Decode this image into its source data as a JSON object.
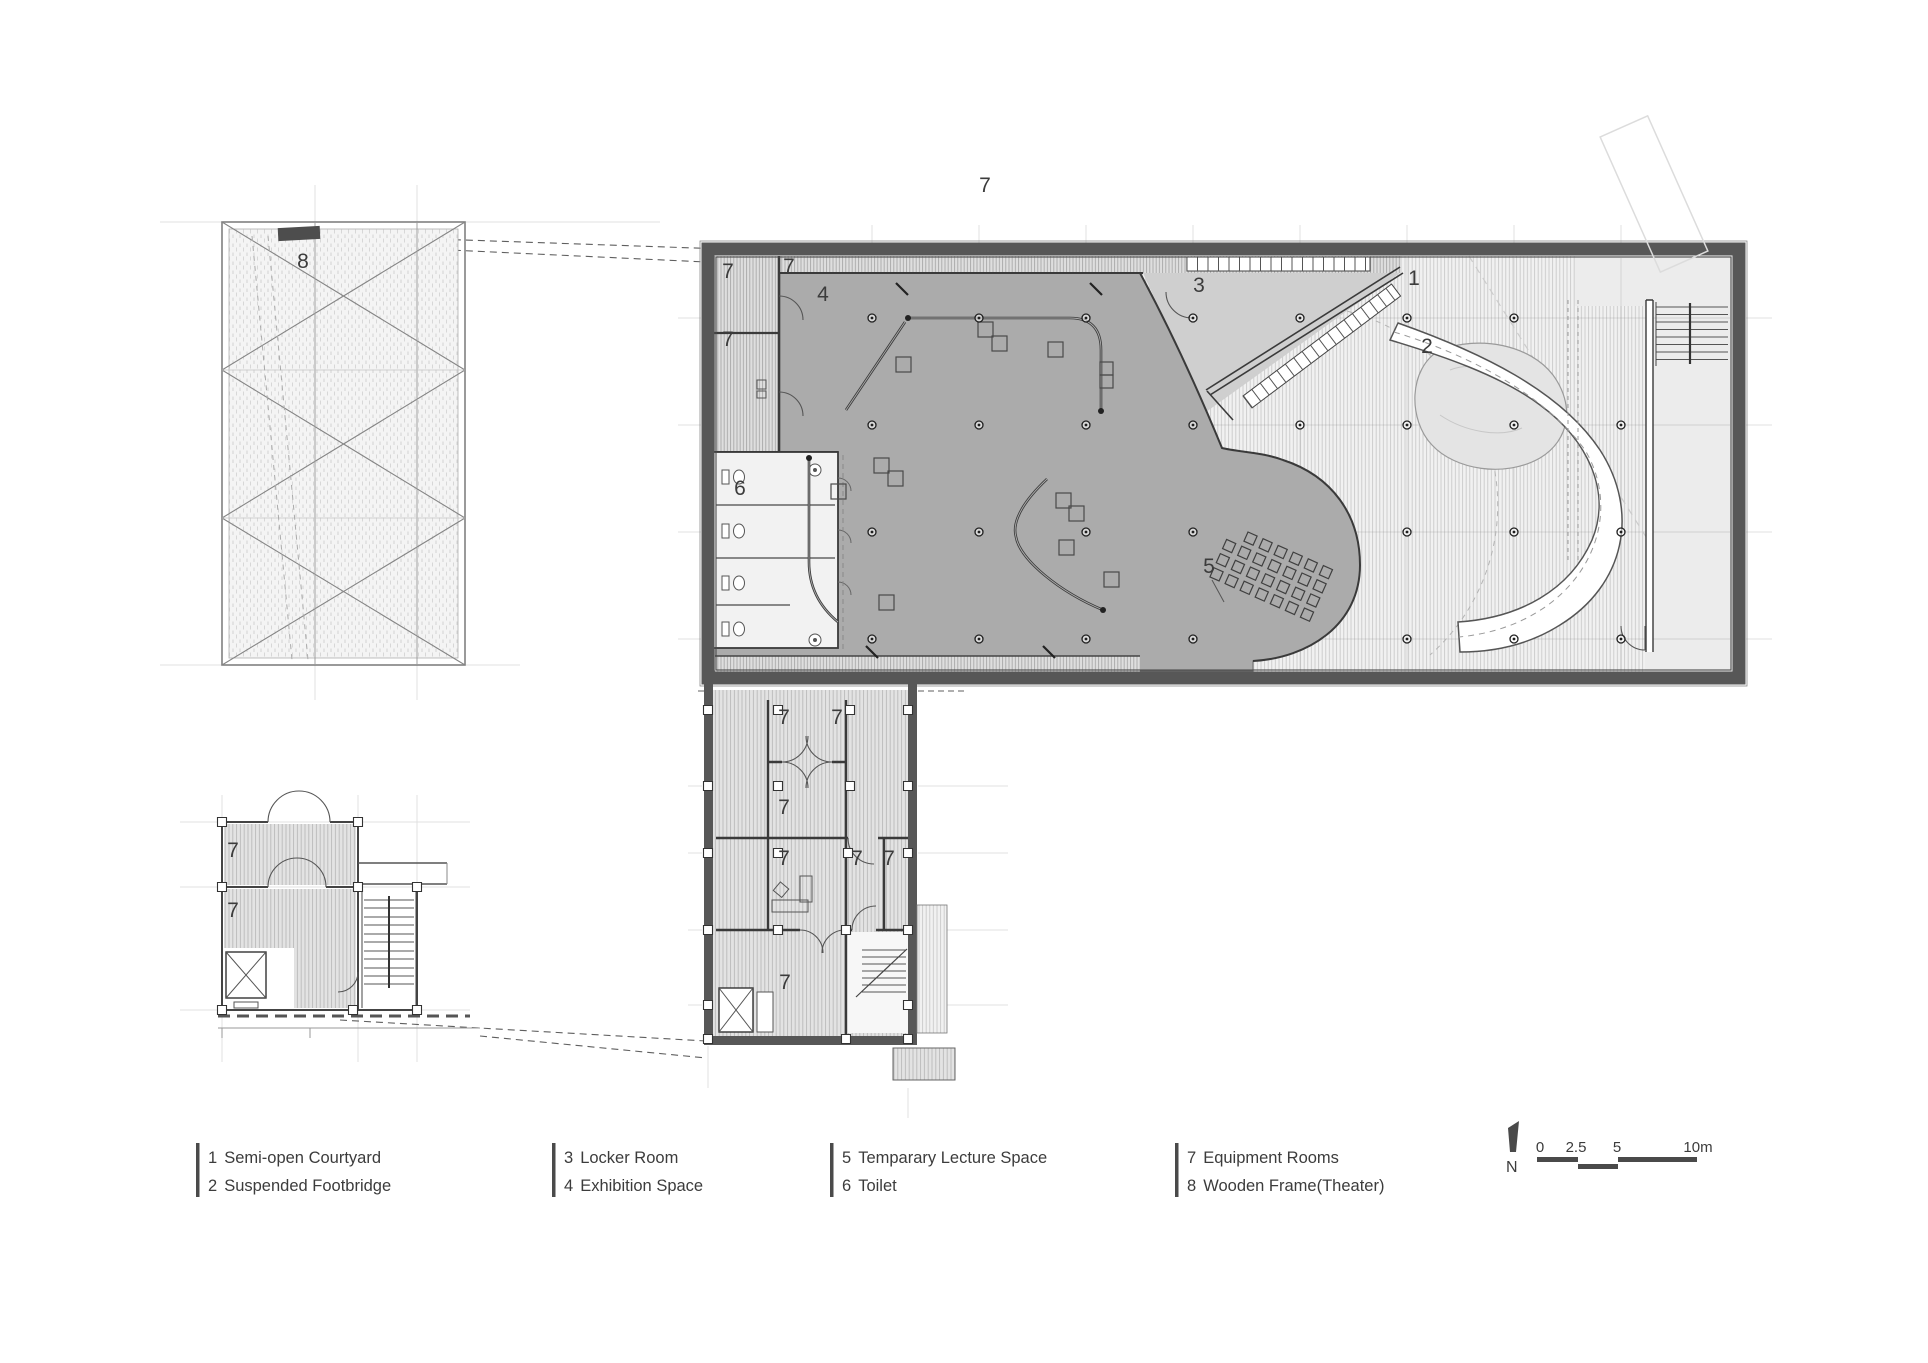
{
  "plan_labels": {
    "roof": "7",
    "courtyard": "1",
    "footbridge": "2",
    "locker": "3",
    "exhibition": "4",
    "lecture": "5",
    "toilet": "6",
    "equipment": "7",
    "wooden_frame": "8"
  },
  "legend": {
    "groups": [
      {
        "items": [
          {
            "num": "1",
            "label": "Semi-open Courtyard"
          },
          {
            "num": "2",
            "label": "Suspended Footbridge"
          }
        ]
      },
      {
        "items": [
          {
            "num": "3",
            "label": "Locker Room"
          },
          {
            "num": "4",
            "label": "Exhibition Space"
          }
        ]
      },
      {
        "items": [
          {
            "num": "5",
            "label": "Temparary Lecture Space"
          },
          {
            "num": "6",
            "label": "Toilet"
          }
        ]
      },
      {
        "items": [
          {
            "num": "7",
            "label": "Equipment Rooms"
          },
          {
            "num": "8",
            "label": "Wooden Frame(Theater)"
          }
        ]
      }
    ]
  },
  "compass": {
    "north_label": "N"
  },
  "scale_bar": {
    "ticks": [
      "0",
      "2.5",
      "5",
      "10m"
    ]
  },
  "colors": {
    "wall": "#575757",
    "exhibition_floor": "#ababab",
    "locker_floor": "#cfcfcf",
    "courtyard_base": "#f1f1f1",
    "text": "#3c3c3c"
  }
}
